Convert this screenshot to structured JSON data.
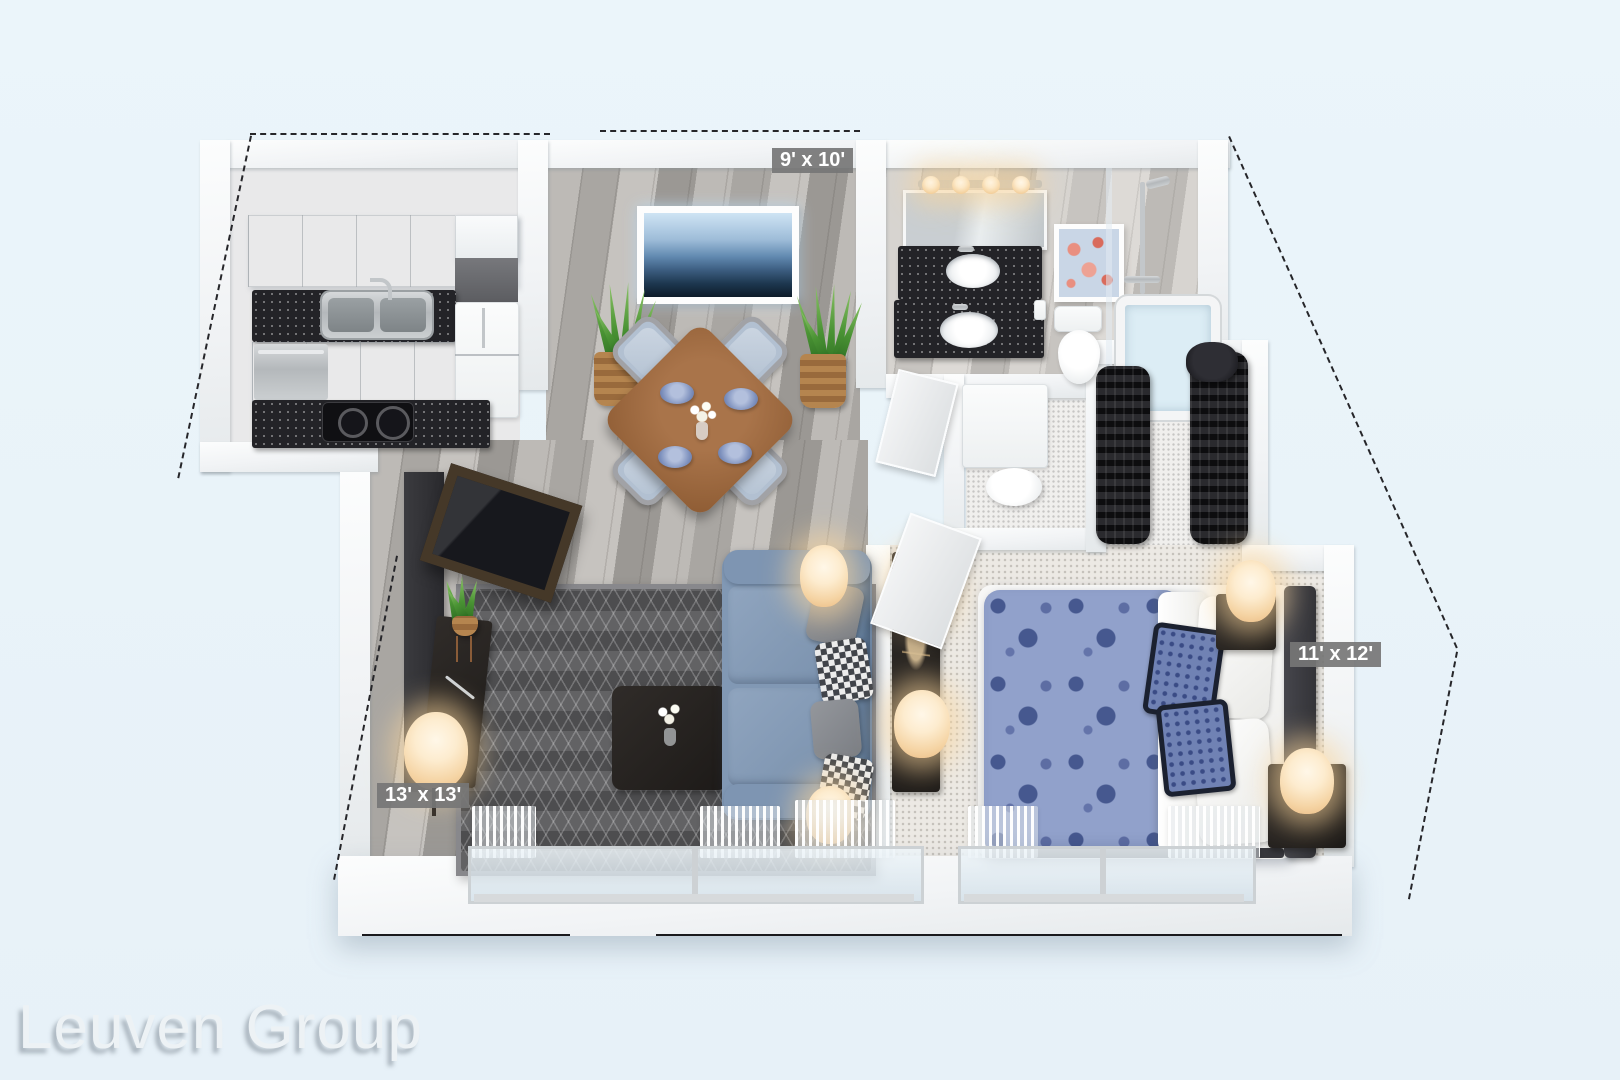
{
  "page": {
    "background": "#e9f3f9"
  },
  "watermark": {
    "text": "Leuven Group"
  },
  "floorplan": {
    "style": "3D dollhouse apartment render, one bedroom unit",
    "room_labels": [
      {
        "room": "dining-area",
        "text": "9' x 10'"
      },
      {
        "room": "living-room",
        "text": "13' x 13'"
      },
      {
        "room": "bedroom",
        "text": "11' x 12'"
      }
    ],
    "rooms": [
      "kitchen",
      "dining-area",
      "bathroom",
      "utility-closet",
      "walk-in-closet",
      "living-room",
      "bedroom"
    ],
    "colors": {
      "label_background": "#767676",
      "label_text": "#ffffff",
      "wall": "#f6f8f9",
      "wood_floor": "#b3b0ac",
      "bath_floor": "#d2cfcb",
      "bedroom_carpet": "#ece9e4",
      "rug": "#58585a",
      "sofa": "#7f96b2",
      "bed_duvet": "#8fa0ca",
      "countertop": "#232327",
      "lamp_glow": "#f8ddb2",
      "plant": "#4a9334",
      "dining_table_wood": "#9a6a40"
    }
  }
}
